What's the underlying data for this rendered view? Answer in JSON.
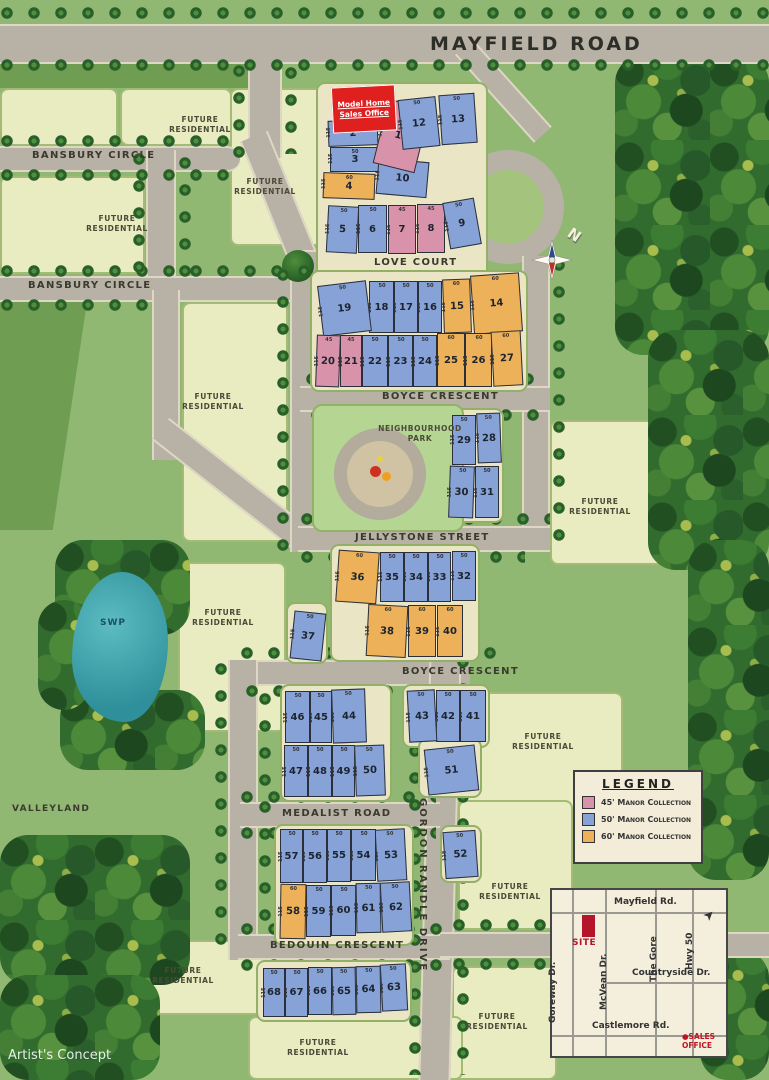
{
  "map": {
    "artist_concept": "Artist's Concept",
    "compass_label": "N"
  },
  "roads": {
    "mayfield": "MAYFIELD ROAD",
    "bansbury1": "BANSBURY CIRCLE",
    "bansbury2": "BANSBURY CIRCLE",
    "love_court": "LOVE COURT",
    "boyce1": "BOYCE CRESCENT",
    "jellystone": "JELLYSTONE STREET",
    "boyce2": "BOYCE CRESCENT",
    "medalist": "MEDALIST ROAD",
    "bedouin": "BEDOUIN CRESCENT",
    "gordon": "GORDON RANDLE DRIVE"
  },
  "labels": {
    "future_residential": "FUTURE RESIDENTIAL",
    "neighbourhood_park": "NEIGHBOURHOOD PARK",
    "swp": "SWP",
    "valleyland": "VALLEYLAND",
    "sales_office": "Model Home Sales Office"
  },
  "legend": {
    "title": "LEGEND",
    "items": [
      {
        "label": "45' Manor Collection",
        "color": "#d893ab"
      },
      {
        "label": "50' Manor Collection",
        "color": "#87a2d6"
      },
      {
        "label": "60' Manor Collection",
        "color": "#edb159"
      }
    ]
  },
  "inset": {
    "roads_h": [
      "Mayfield Rd.",
      "Countryside Dr.",
      "Castlemore Rd."
    ],
    "roads_v": [
      "Goreway Dr.",
      "McVean Dr.",
      "The Gore",
      "Hwy 50"
    ],
    "site_label": "SITE",
    "sales_office_label": "SALES OFFICE"
  },
  "collections": {
    "45": {
      "front": "45",
      "depth": "115",
      "color": "#d893ab"
    },
    "50": {
      "front": "50",
      "depth": "115",
      "color": "#87a2d6"
    },
    "60": {
      "front": "60",
      "depth": "115",
      "color": "#edb159"
    }
  },
  "lots": [
    {
      "n": 2,
      "t": "50",
      "x": 328,
      "y": 120,
      "w": 50,
      "h": 26,
      "r": -2
    },
    {
      "n": 3,
      "t": "50",
      "x": 330,
      "y": 147,
      "w": 50,
      "h": 25,
      "r": 0
    },
    {
      "n": 4,
      "t": "60",
      "x": 323,
      "y": 173,
      "w": 52,
      "h": 26,
      "r": 2
    },
    {
      "n": 5,
      "t": "50",
      "x": 327,
      "y": 206,
      "w": 31,
      "h": 47,
      "r": 3
    },
    {
      "n": 6,
      "t": "50",
      "x": 358,
      "y": 205,
      "w": 29,
      "h": 48,
      "r": 0
    },
    {
      "n": 7,
      "t": "45",
      "x": 388,
      "y": 205,
      "w": 28,
      "h": 49,
      "r": 0
    },
    {
      "n": 8,
      "t": "45",
      "x": 417,
      "y": 204,
      "w": 28,
      "h": 49,
      "r": 0
    },
    {
      "n": 9,
      "t": "50",
      "x": 446,
      "y": 200,
      "w": 32,
      "h": 47,
      "r": -10
    },
    {
      "n": 10,
      "t": "50",
      "x": 377,
      "y": 160,
      "w": 51,
      "h": 36,
      "r": 5
    },
    {
      "n": 11,
      "t": "45",
      "x": 380,
      "y": 103,
      "w": 43,
      "h": 66,
      "r": 14
    },
    {
      "n": 12,
      "t": "50",
      "x": 400,
      "y": 98,
      "w": 38,
      "h": 50,
      "r": -6
    },
    {
      "n": 13,
      "t": "50",
      "x": 440,
      "y": 94,
      "w": 36,
      "h": 50,
      "r": -4
    },
    {
      "n": 14,
      "t": "60",
      "x": 472,
      "y": 274,
      "w": 49,
      "h": 59,
      "r": -4
    },
    {
      "n": 15,
      "t": "60",
      "x": 443,
      "y": 279,
      "w": 28,
      "h": 54,
      "r": -2
    },
    {
      "n": 16,
      "t": "50",
      "x": 418,
      "y": 281,
      "w": 24,
      "h": 52,
      "r": 0
    },
    {
      "n": 17,
      "t": "50",
      "x": 394,
      "y": 281,
      "w": 24,
      "h": 52,
      "r": 0
    },
    {
      "n": 18,
      "t": "50",
      "x": 369,
      "y": 281,
      "w": 25,
      "h": 52,
      "r": 0
    },
    {
      "n": 19,
      "t": "50",
      "x": 320,
      "y": 283,
      "w": 49,
      "h": 51,
      "r": -7
    },
    {
      "n": 20,
      "t": "45",
      "x": 316,
      "y": 335,
      "w": 24,
      "h": 52,
      "r": 2
    },
    {
      "n": 21,
      "t": "45",
      "x": 340,
      "y": 335,
      "w": 22,
      "h": 52,
      "r": 0
    },
    {
      "n": 22,
      "t": "50",
      "x": 362,
      "y": 335,
      "w": 26,
      "h": 52,
      "r": 0
    },
    {
      "n": 23,
      "t": "50",
      "x": 388,
      "y": 335,
      "w": 25,
      "h": 52,
      "r": 0
    },
    {
      "n": 24,
      "t": "50",
      "x": 413,
      "y": 335,
      "w": 24,
      "h": 52,
      "r": 0
    },
    {
      "n": 25,
      "t": "60",
      "x": 437,
      "y": 333,
      "w": 28,
      "h": 54,
      "r": 0
    },
    {
      "n": 26,
      "t": "60",
      "x": 465,
      "y": 333,
      "w": 27,
      "h": 54,
      "r": 0
    },
    {
      "n": 27,
      "t": "60",
      "x": 492,
      "y": 331,
      "w": 30,
      "h": 55,
      "r": -3
    },
    {
      "n": 28,
      "t": "50",
      "x": 477,
      "y": 413,
      "w": 24,
      "h": 50,
      "r": -2
    },
    {
      "n": 29,
      "t": "50",
      "x": 452,
      "y": 415,
      "w": 24,
      "h": 50,
      "r": 0
    },
    {
      "n": 30,
      "t": "50",
      "x": 449,
      "y": 466,
      "w": 25,
      "h": 52,
      "r": 2
    },
    {
      "n": 31,
      "t": "50",
      "x": 475,
      "y": 466,
      "w": 24,
      "h": 52,
      "r": 0
    },
    {
      "n": 32,
      "t": "50",
      "x": 452,
      "y": 551,
      "w": 24,
      "h": 50,
      "r": 0
    },
    {
      "n": 33,
      "t": "50",
      "x": 428,
      "y": 552,
      "w": 23,
      "h": 50,
      "r": 0
    },
    {
      "n": 34,
      "t": "50",
      "x": 404,
      "y": 552,
      "w": 24,
      "h": 50,
      "r": 0
    },
    {
      "n": 35,
      "t": "50",
      "x": 380,
      "y": 552,
      "w": 24,
      "h": 50,
      "r": 0
    },
    {
      "n": 36,
      "t": "60",
      "x": 337,
      "y": 551,
      "w": 41,
      "h": 52,
      "r": 4
    },
    {
      "n": 37,
      "t": "50",
      "x": 292,
      "y": 612,
      "w": 32,
      "h": 48,
      "r": 6
    },
    {
      "n": 38,
      "t": "60",
      "x": 367,
      "y": 605,
      "w": 40,
      "h": 52,
      "r": 3
    },
    {
      "n": 39,
      "t": "60",
      "x": 408,
      "y": 605,
      "w": 28,
      "h": 52,
      "r": 0
    },
    {
      "n": 40,
      "t": "60",
      "x": 437,
      "y": 605,
      "w": 26,
      "h": 52,
      "r": 0
    },
    {
      "n": 41,
      "t": "50",
      "x": 460,
      "y": 690,
      "w": 26,
      "h": 52,
      "r": 0
    },
    {
      "n": 42,
      "t": "50",
      "x": 436,
      "y": 690,
      "w": 24,
      "h": 52,
      "r": 0
    },
    {
      "n": 43,
      "t": "50",
      "x": 408,
      "y": 690,
      "w": 28,
      "h": 52,
      "r": -3
    },
    {
      "n": 44,
      "t": "50",
      "x": 332,
      "y": 689,
      "w": 34,
      "h": 54,
      "r": -2
    },
    {
      "n": 45,
      "t": "50",
      "x": 310,
      "y": 691,
      "w": 22,
      "h": 52,
      "r": 0
    },
    {
      "n": 46,
      "t": "50",
      "x": 285,
      "y": 691,
      "w": 25,
      "h": 52,
      "r": 0
    },
    {
      "n": 47,
      "t": "50",
      "x": 284,
      "y": 745,
      "w": 24,
      "h": 52,
      "r": 0
    },
    {
      "n": 48,
      "t": "50",
      "x": 308,
      "y": 745,
      "w": 24,
      "h": 52,
      "r": 0
    },
    {
      "n": 49,
      "t": "50",
      "x": 332,
      "y": 745,
      "w": 23,
      "h": 52,
      "r": 0
    },
    {
      "n": 50,
      "t": "50",
      "x": 355,
      "y": 745,
      "w": 30,
      "h": 51,
      "r": -2
    },
    {
      "n": 51,
      "t": "50",
      "x": 426,
      "y": 747,
      "w": 51,
      "h": 46,
      "r": -6
    },
    {
      "n": 52,
      "t": "50",
      "x": 444,
      "y": 831,
      "w": 33,
      "h": 47,
      "r": -4
    },
    {
      "n": 53,
      "t": "50",
      "x": 376,
      "y": 829,
      "w": 30,
      "h": 52,
      "r": -3
    },
    {
      "n": 54,
      "t": "50",
      "x": 351,
      "y": 829,
      "w": 25,
      "h": 52,
      "r": 0
    },
    {
      "n": 55,
      "t": "50",
      "x": 327,
      "y": 829,
      "w": 24,
      "h": 53,
      "r": 0
    },
    {
      "n": 56,
      "t": "50",
      "x": 303,
      "y": 829,
      "w": 24,
      "h": 54,
      "r": 0
    },
    {
      "n": 57,
      "t": "50",
      "x": 280,
      "y": 829,
      "w": 23,
      "h": 54,
      "r": 0
    },
    {
      "n": 58,
      "t": "60",
      "x": 280,
      "y": 884,
      "w": 26,
      "h": 55,
      "r": 1
    },
    {
      "n": 59,
      "t": "50",
      "x": 306,
      "y": 885,
      "w": 25,
      "h": 52,
      "r": 0
    },
    {
      "n": 60,
      "t": "50",
      "x": 331,
      "y": 885,
      "w": 25,
      "h": 51,
      "r": 0
    },
    {
      "n": 61,
      "t": "50",
      "x": 356,
      "y": 883,
      "w": 25,
      "h": 50,
      "r": -1
    },
    {
      "n": 62,
      "t": "50",
      "x": 381,
      "y": 882,
      "w": 30,
      "h": 50,
      "r": -3
    },
    {
      "n": 63,
      "t": "50",
      "x": 381,
      "y": 964,
      "w": 26,
      "h": 47,
      "r": -3
    },
    {
      "n": 64,
      "t": "50",
      "x": 356,
      "y": 966,
      "w": 25,
      "h": 47,
      "r": -1
    },
    {
      "n": 65,
      "t": "50",
      "x": 332,
      "y": 967,
      "w": 24,
      "h": 48,
      "r": -1
    },
    {
      "n": 66,
      "t": "50",
      "x": 308,
      "y": 967,
      "w": 24,
      "h": 48,
      "r": 0
    },
    {
      "n": 67,
      "t": "50",
      "x": 285,
      "y": 968,
      "w": 23,
      "h": 49,
      "r": 0
    },
    {
      "n": 68,
      "t": "50",
      "x": 263,
      "y": 968,
      "w": 22,
      "h": 49,
      "r": 0
    }
  ]
}
